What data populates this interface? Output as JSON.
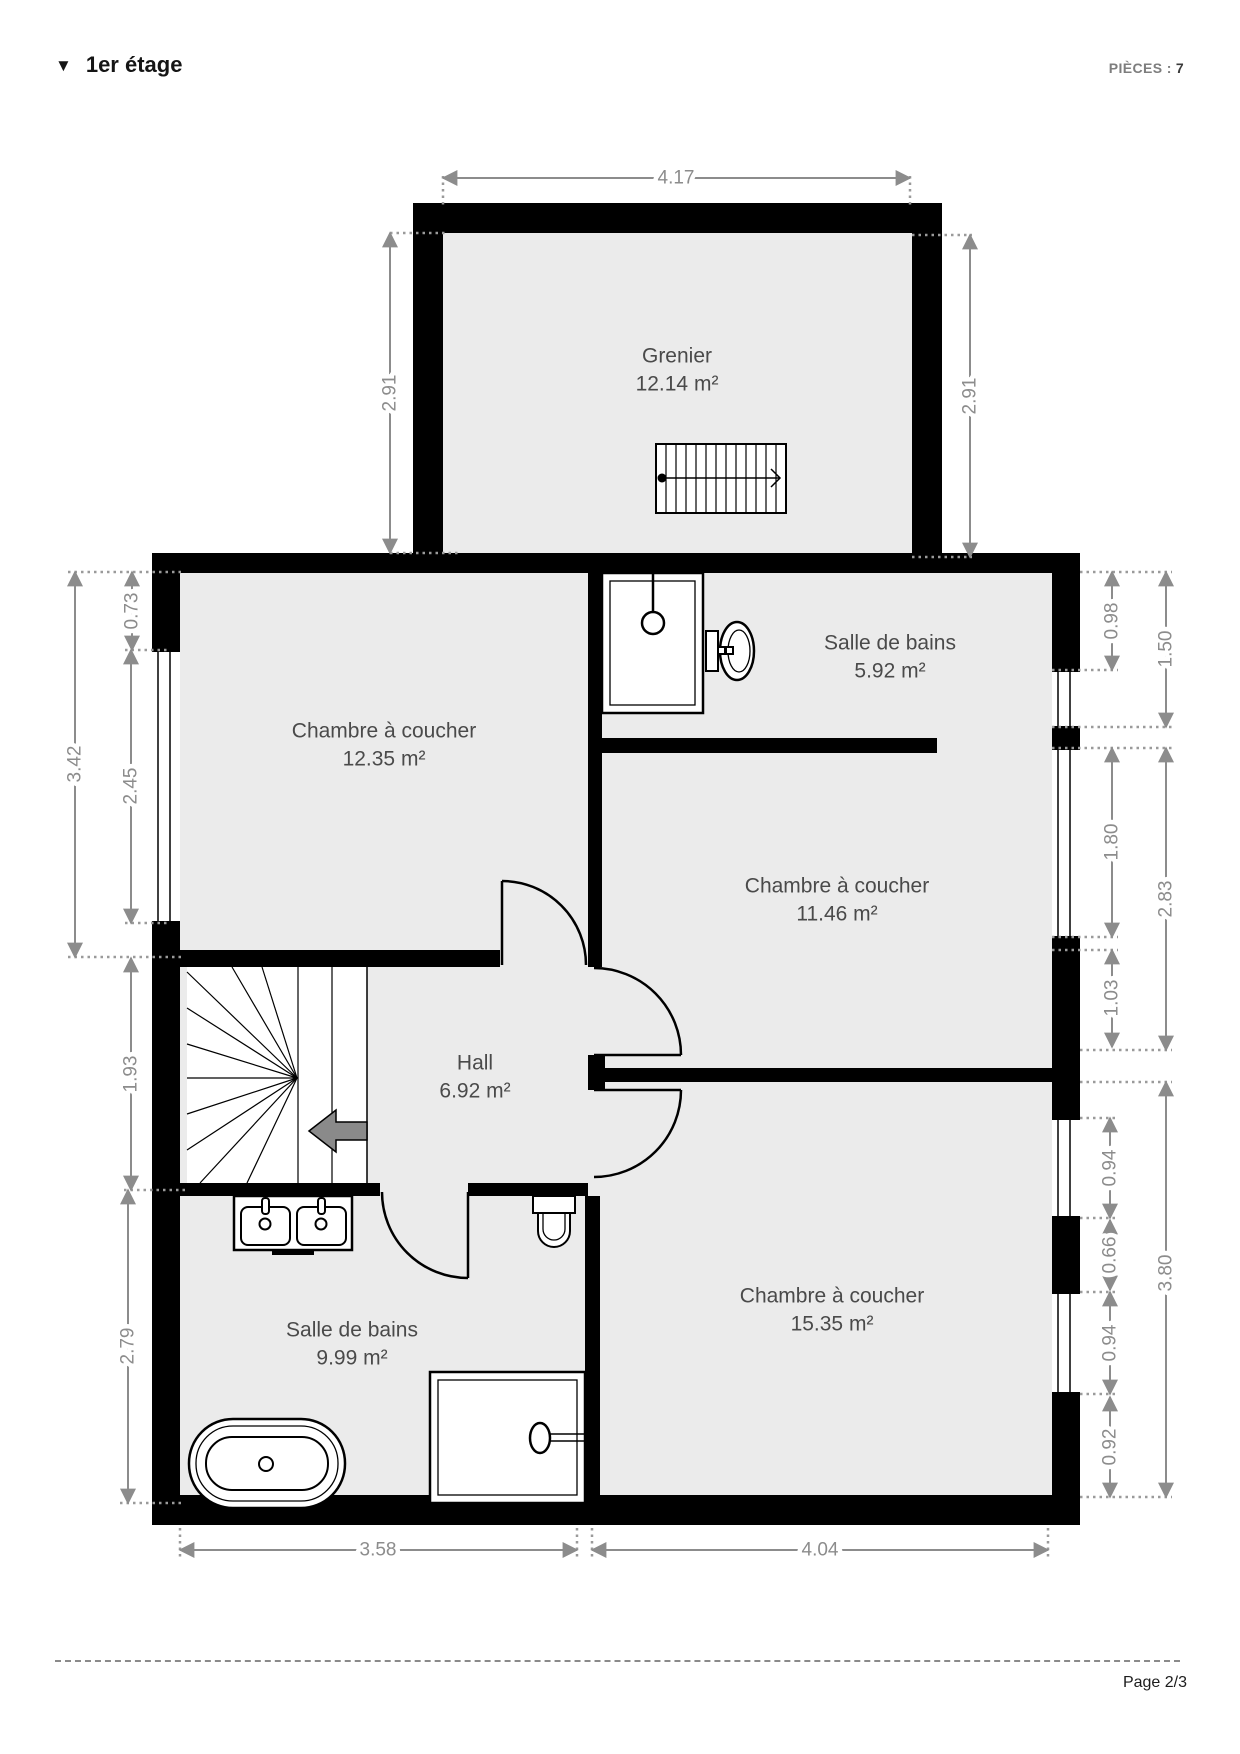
{
  "header": {
    "collapse_icon": "▼",
    "title": "1er étage",
    "pieces_label": "PIÈCES :",
    "pieces_value": "7"
  },
  "footer": {
    "page_label": "Page 2/3"
  },
  "floor_plan": {
    "rooms": {
      "grenier": {
        "name": "Grenier",
        "area": "12.14 m²"
      },
      "bedroom_top_left": {
        "name": "Chambre à coucher",
        "area": "12.35 m²"
      },
      "bathroom_top": {
        "name": "Salle de bains",
        "area": "5.92 m²"
      },
      "bedroom_middle_right": {
        "name": "Chambre à coucher",
        "area": "11.46 m²"
      },
      "hall": {
        "name": "Hall",
        "area": "6.92 m²"
      },
      "bathroom_bottom": {
        "name": "Salle de bains",
        "area": "9.99 m²"
      },
      "bedroom_bottom_right": {
        "name": "Chambre à coucher",
        "area": "15.35 m²"
      }
    },
    "dimensions": {
      "grenier_width": "4.17",
      "grenier_height_left": "2.91",
      "grenier_height_right": "2.91",
      "left_wall_top_segment": "0.73",
      "left_total_upper": "3.42",
      "left_window": "2.45",
      "left_stairs": "1.93",
      "left_bathroom": "2.79",
      "right_wall_top_segment": "0.98",
      "right_to_window": "1.50",
      "right_window_upper": "1.80",
      "right_bedroom_mid": "2.83",
      "right_below_window": "1.03",
      "right_window_a": "0.94",
      "right_pier": "0.66",
      "right_window_b": "0.94",
      "right_wall_bottom_segment": "0.92",
      "right_bedroom_bottom": "3.80",
      "bottom_bathroom": "3.58",
      "bottom_bedroom": "4.04"
    },
    "colors": {
      "wall": "#000000",
      "room_fill": "#ebebeb",
      "dimension_gray": "#8c8c8c",
      "room_label_gray": "#4a4a4a"
    }
  }
}
